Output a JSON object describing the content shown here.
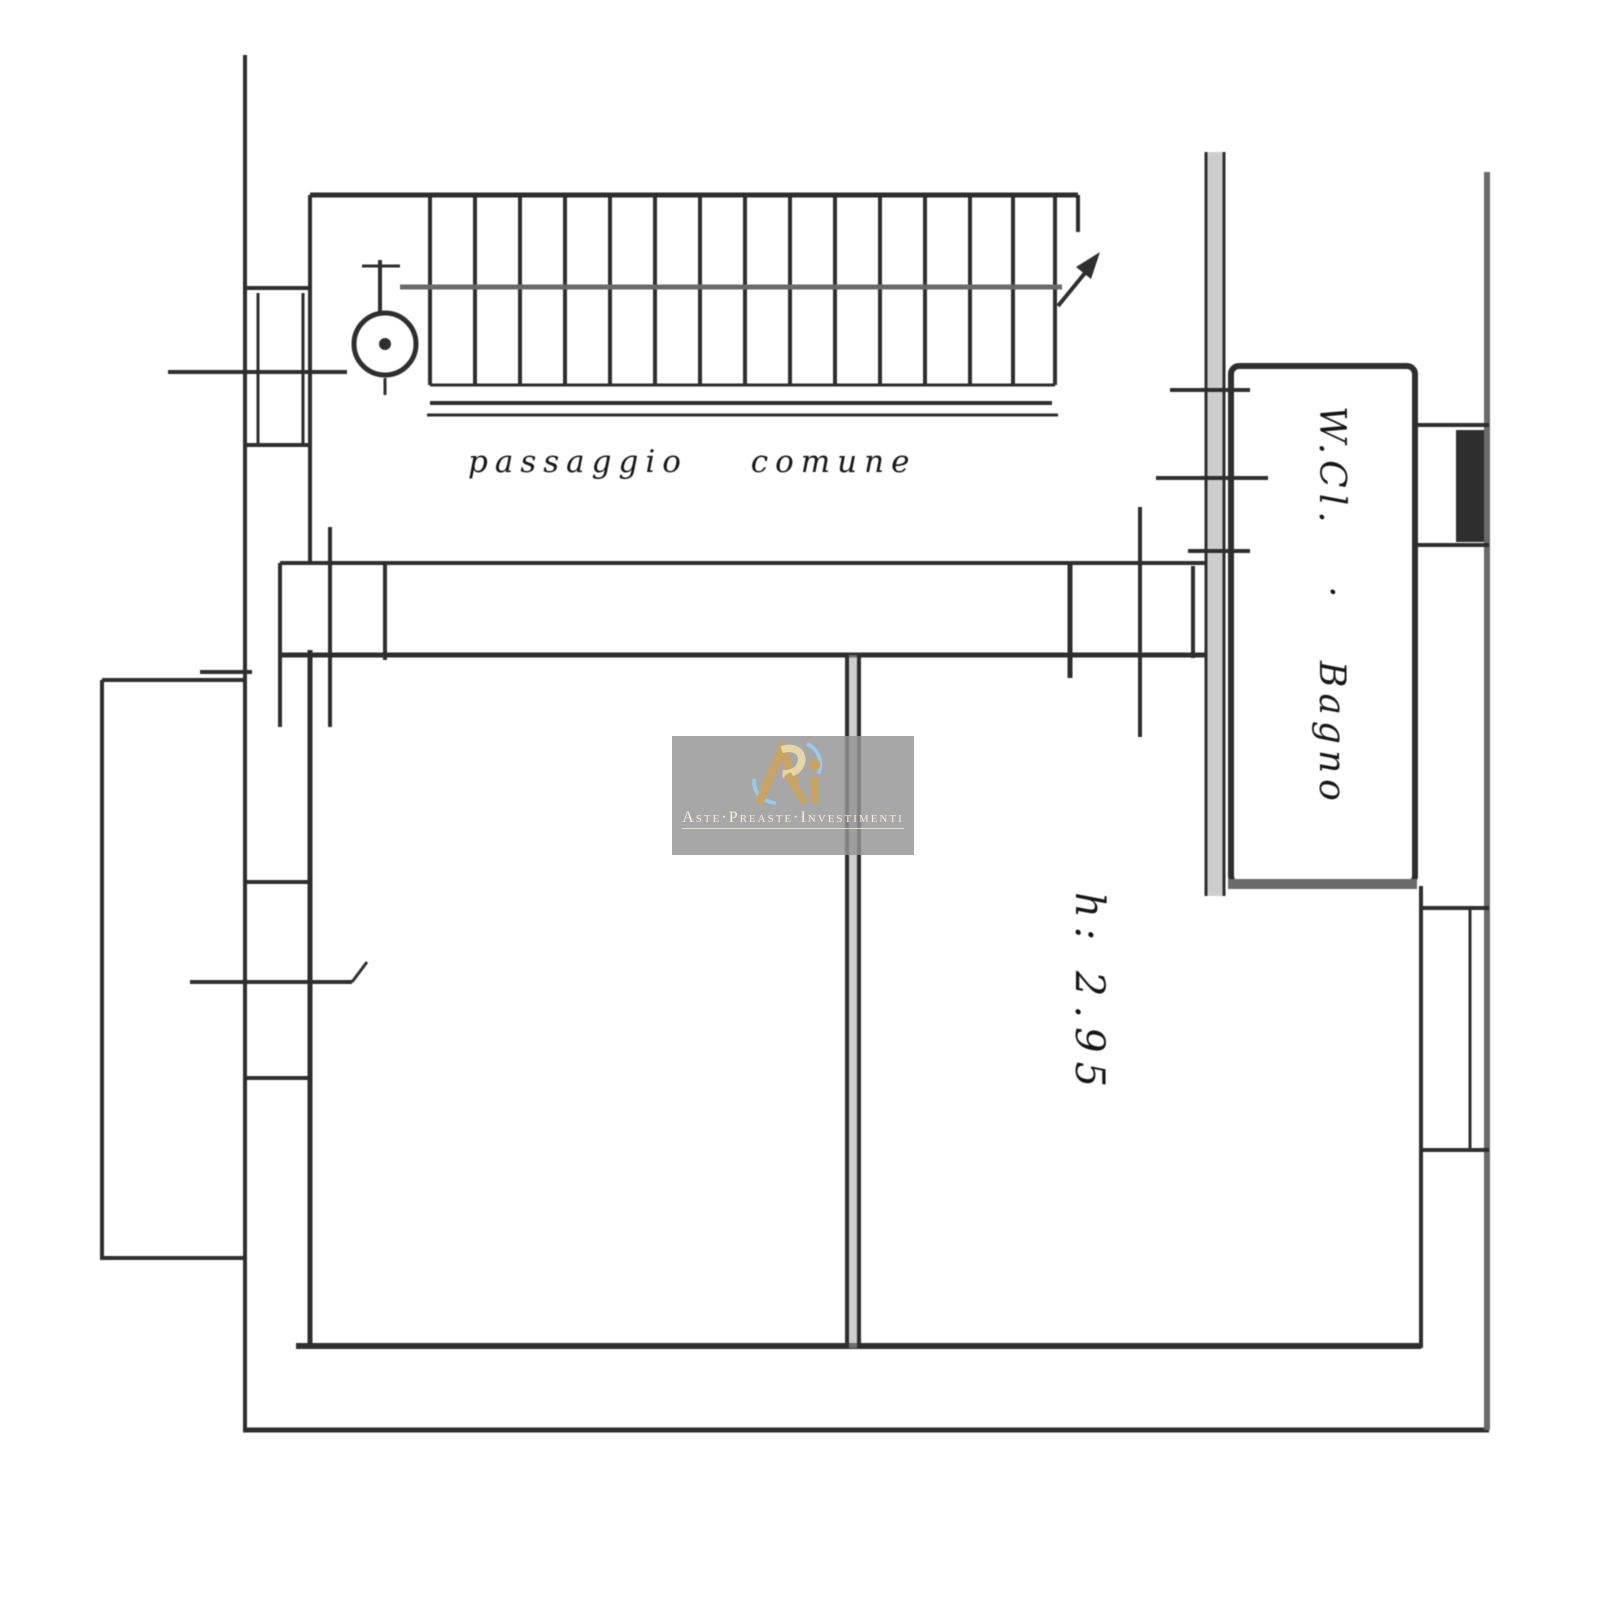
{
  "plan": {
    "corridor_label": "passaggio comune",
    "room_height_label": "h: 2.95",
    "bathroom_label": "W.Cl. · Bagno",
    "colors": {
      "line": "#2e2e2e",
      "soft_line": "#6a6a6a",
      "wall_fill": "#a6a6a6",
      "background": "#ffffff"
    }
  },
  "watermark": {
    "caption": "Aste·Preaste·Investimenti",
    "logo_icon": "apri-monogram",
    "colors": {
      "overlay": "rgba(148,148,148,0.82)",
      "gold": "#c8a467",
      "gold_light": "#e7d5a5",
      "blue": "#9cc9e8",
      "text": "#f4eedd"
    }
  }
}
